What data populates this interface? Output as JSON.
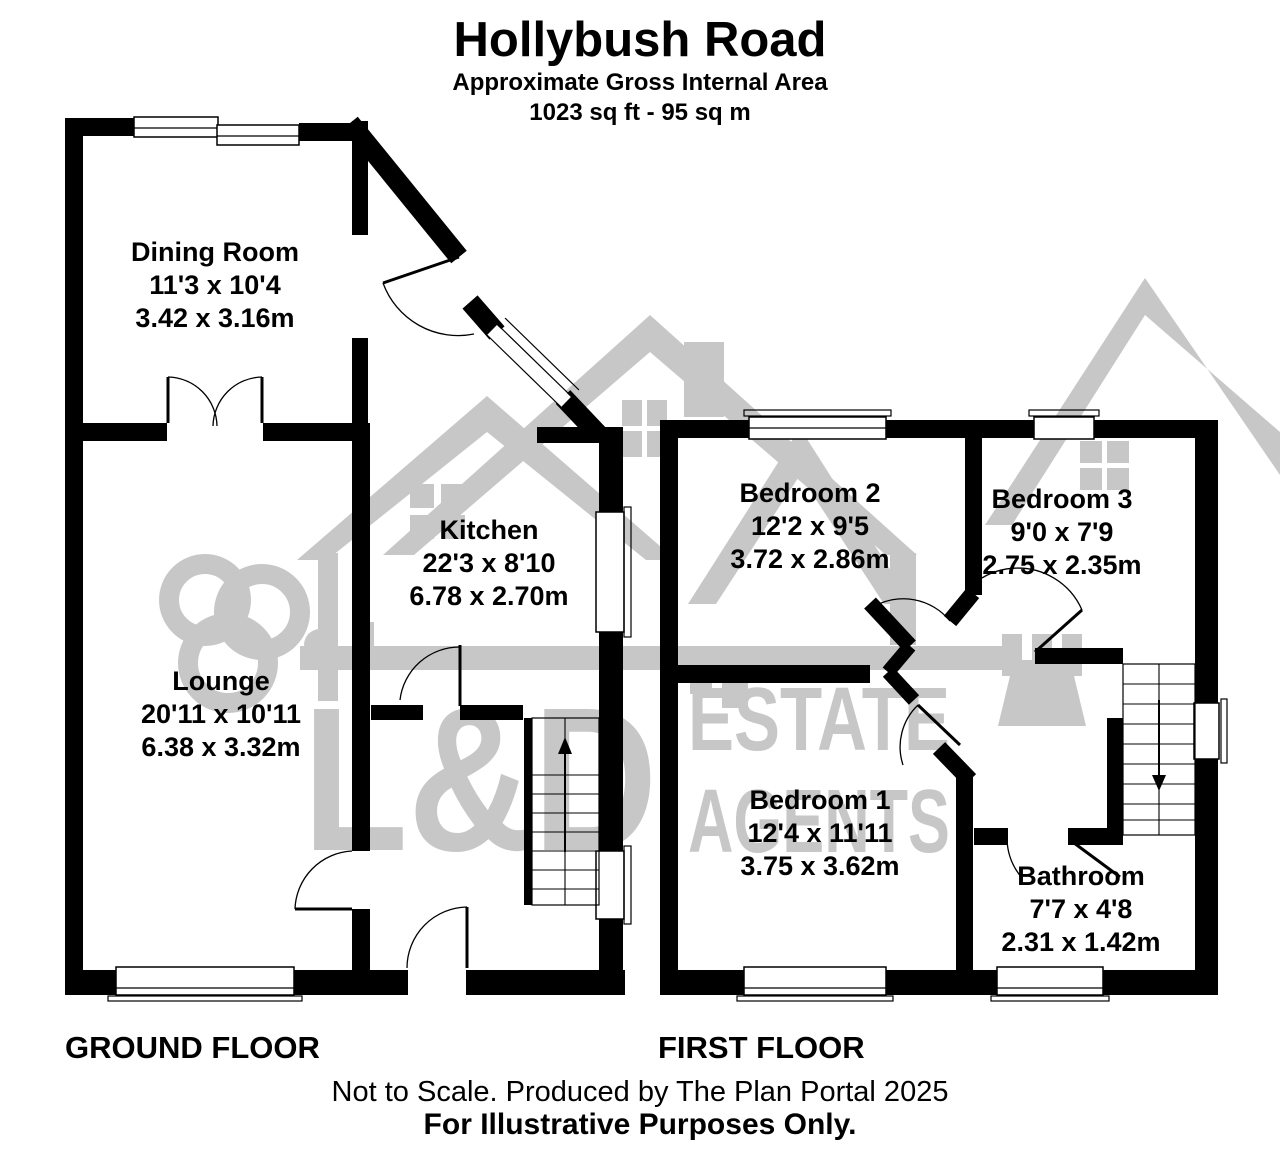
{
  "header": {
    "title": "Hollybush Road",
    "subtitle": "Approximate Gross Internal Area",
    "area": "1023 sq ft - 95 sq m"
  },
  "floors": {
    "ground": {
      "label": "GROUND FLOOR",
      "rooms": {
        "dining": {
          "name": "Dining Room",
          "imperial": "11'3 x 10'4",
          "metric": "3.42 x 3.16m"
        },
        "kitchen": {
          "name": "Kitchen",
          "imperial": "22'3 x 8'10",
          "metric": "6.78 x 2.70m"
        },
        "lounge": {
          "name": "Lounge",
          "imperial": "20'11 x 10'11",
          "metric": "6.38 x 3.32m"
        }
      }
    },
    "first": {
      "label": "FIRST FLOOR",
      "rooms": {
        "bedroom2": {
          "name": "Bedroom 2",
          "imperial": "12'2 x 9'5",
          "metric": "3.72 x 2.86m"
        },
        "bedroom3": {
          "name": "Bedroom 3",
          "imperial": "9'0 x 7'9",
          "metric": "2.75 x 2.35m"
        },
        "bedroom1": {
          "name": "Bedroom 1",
          "imperial": "12'4 x 11'11",
          "metric": "3.75 x 3.62m"
        },
        "bathroom": {
          "name": "Bathroom",
          "imperial": "7'7 x 4'8",
          "metric": "2.31 x 1.42m"
        }
      }
    }
  },
  "watermark": {
    "line1": "L&D",
    "line2": "ESTATE",
    "line3": "AGENTS",
    "color": "#c7c7c7"
  },
  "footer": {
    "line1": "Not to Scale. Produced by The Plan Portal 2025",
    "line2": "For Illustrative Purposes Only."
  },
  "colors": {
    "wall": "#000000",
    "background": "#ffffff"
  }
}
